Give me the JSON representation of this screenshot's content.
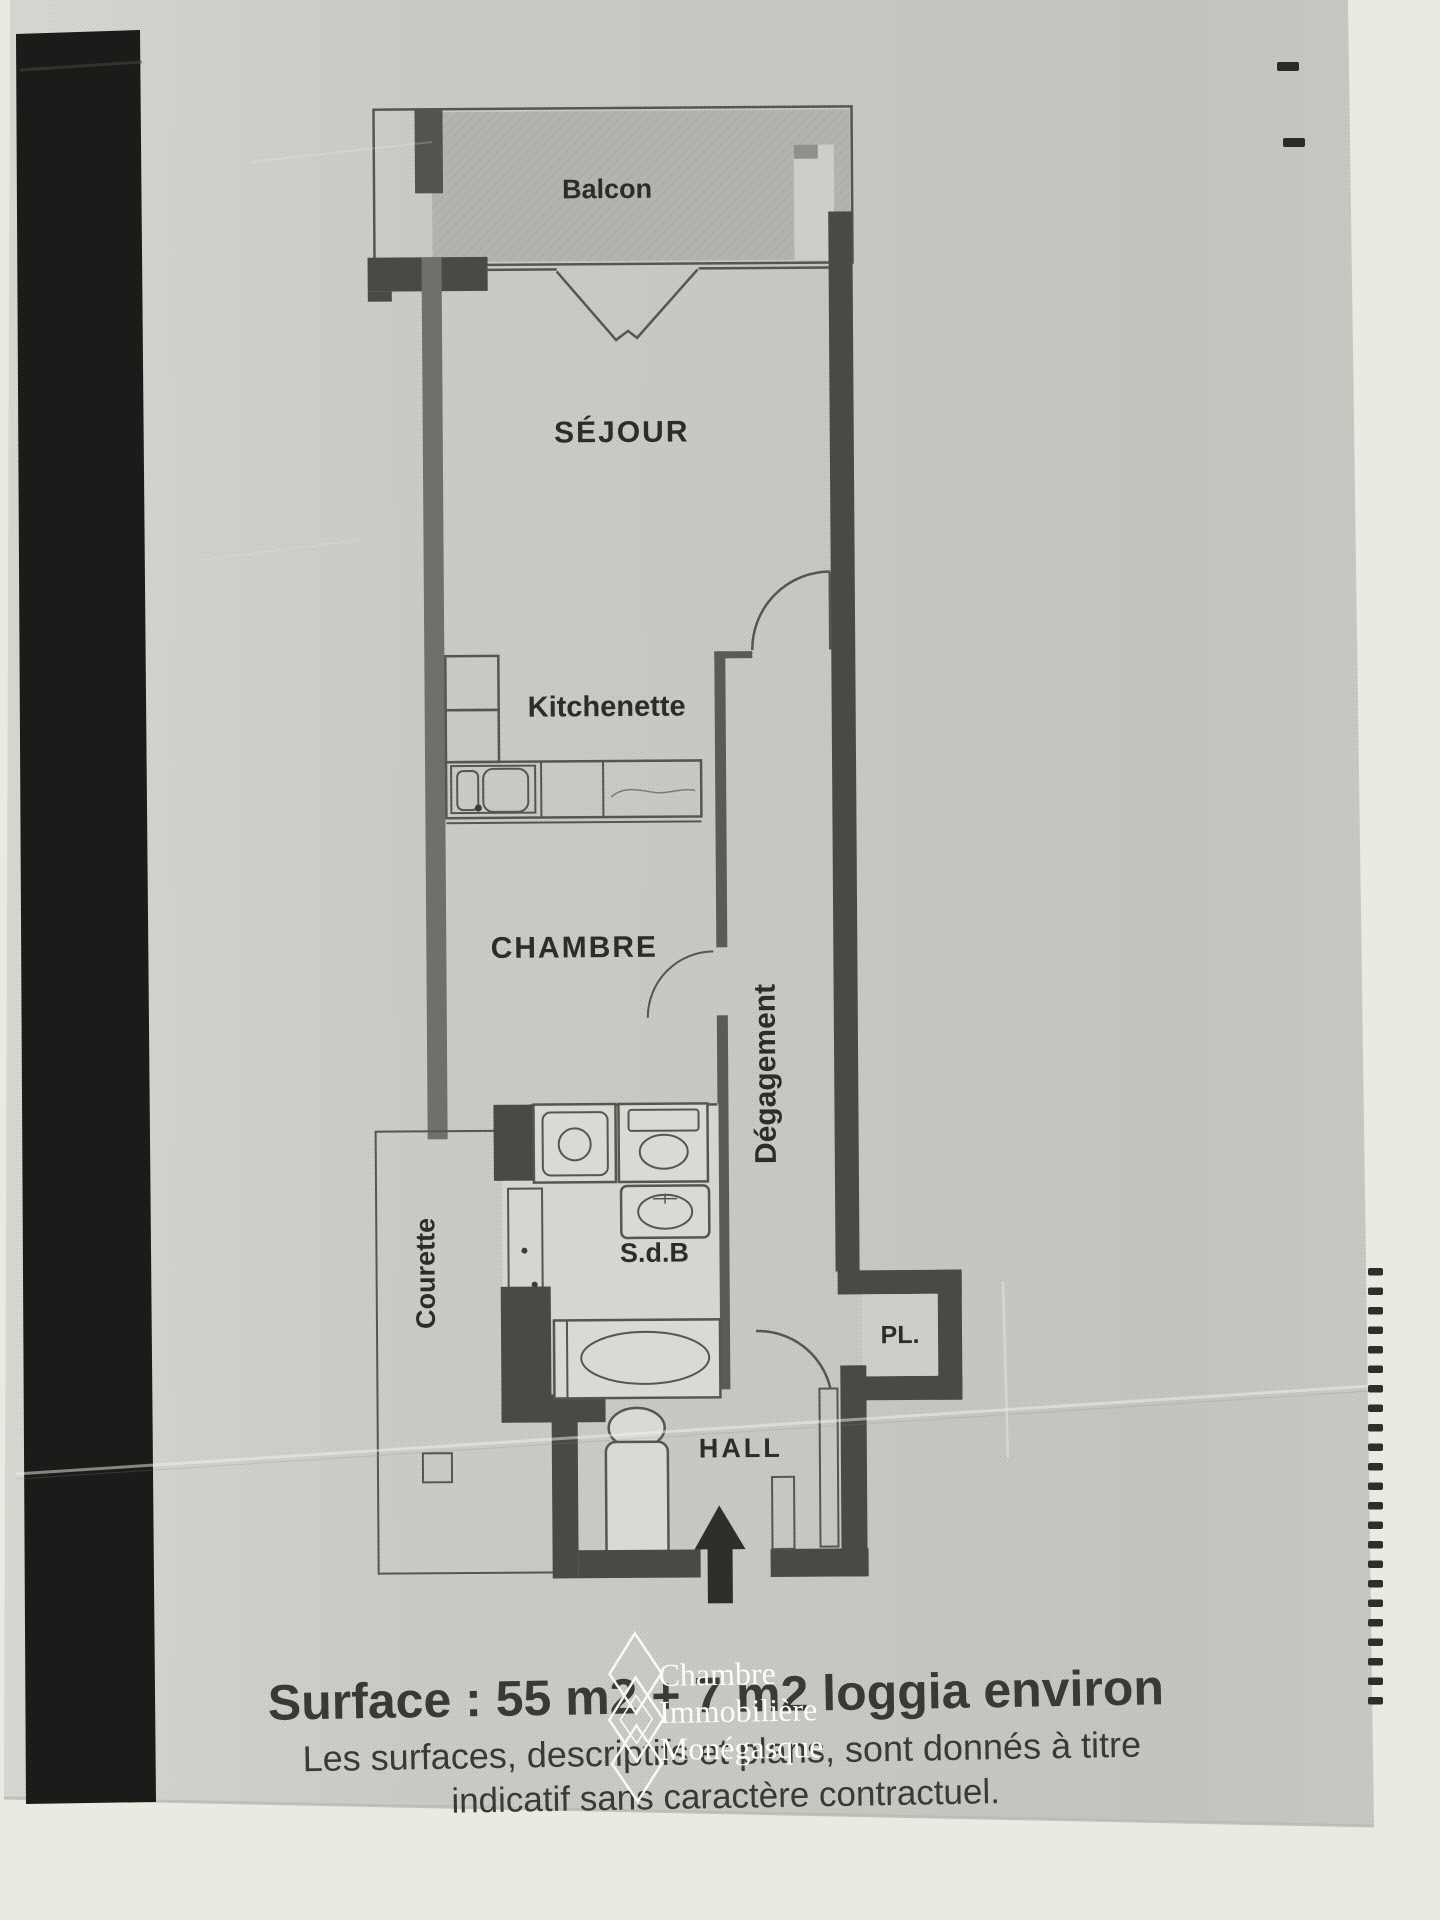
{
  "rooms": {
    "balcon": {
      "label": "Balcon"
    },
    "sejour": {
      "label": "SÉJOUR"
    },
    "kitchenette": {
      "label": "Kitchenette"
    },
    "chambre": {
      "label": "CHAMBRE"
    },
    "degagement": {
      "label": "Dégagement"
    },
    "courette": {
      "label": "Courette"
    },
    "sdb": {
      "label": "S.d.B"
    },
    "placard": {
      "label": "PL."
    },
    "hall": {
      "label": "HALL"
    }
  },
  "footer": {
    "surface_line": "Surface : 55 m2 + 7 m2 loggia environ",
    "disclaimer_line1": "Les surfaces, descriptifs et plans, sont donnés à titre",
    "disclaimer_line2": "indicatif sans caractère contractuel."
  },
  "watermark": {
    "line1": "Chambre",
    "line2": "Immobilière",
    "line3": "Monégasque"
  },
  "colors": {
    "photo_bg": "#e9ebe3",
    "paper": "#cdcec8",
    "black_band": "#1b1b19",
    "wall_dark": "#4a4a45",
    "wall_med": "#70706a",
    "line": "#56564f",
    "balcony_fill": "#b3b4ad",
    "courette_fill": "#a4a59e",
    "fixture_fill": "#d9dad4",
    "ink": "#2d2d28",
    "footer_ink": "#3a3a35",
    "watermark": "#fbfbf8"
  }
}
